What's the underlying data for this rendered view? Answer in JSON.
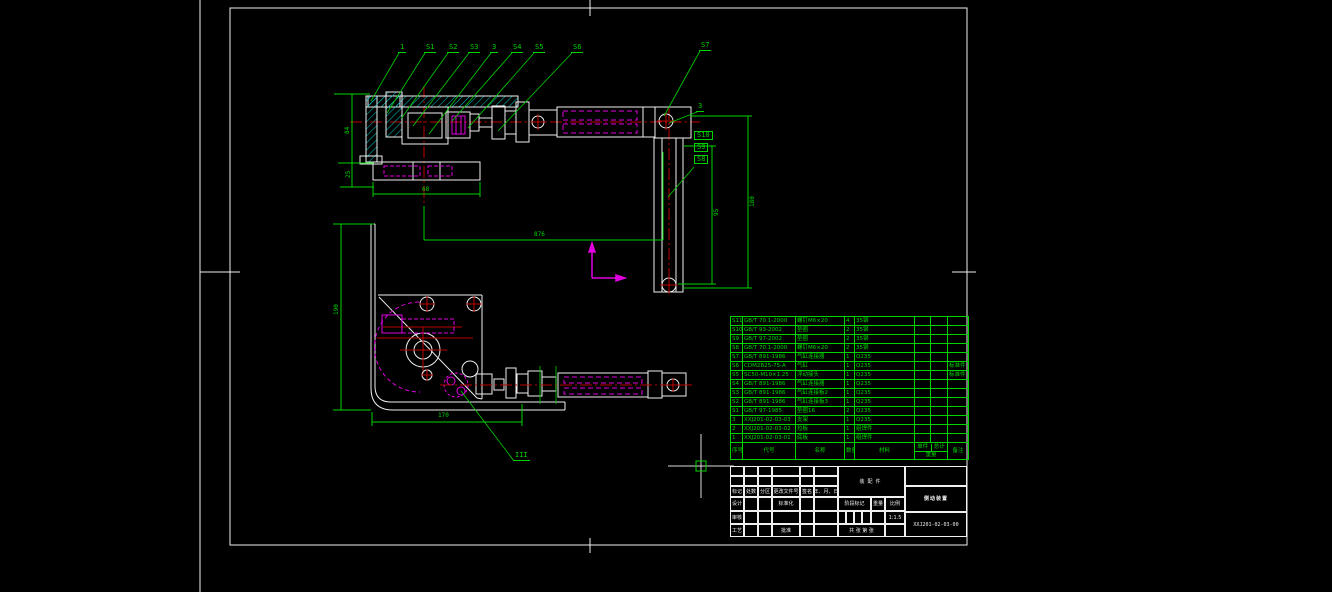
{
  "colors": {
    "background": "#000000",
    "lines_white": "#efefef",
    "lines_green": "#00d400",
    "lines_magenta": "#e000e0",
    "lines_red": "#bb0000",
    "hatch_cyan": "#00c8c8"
  },
  "callouts": [
    {
      "label": "1",
      "x": 398,
      "y": 44,
      "lx": 371,
      "ly": 101
    },
    {
      "label": "S1",
      "x": 424,
      "y": 44,
      "lx": 387,
      "ly": 113
    },
    {
      "label": "S2",
      "x": 447,
      "y": 44,
      "lx": 401,
      "ly": 119
    },
    {
      "label": "S3",
      "x": 468,
      "y": 44,
      "lx": 413,
      "ly": 126
    },
    {
      "label": "3",
      "x": 490,
      "y": 44,
      "lx": 429,
      "ly": 134
    },
    {
      "label": "S4",
      "x": 511,
      "y": 44,
      "lx": 452,
      "ly": 121
    },
    {
      "label": "S5",
      "x": 533,
      "y": 44,
      "lx": 468,
      "ly": 128
    },
    {
      "label": "S6",
      "x": 571,
      "y": 44,
      "lx": 498,
      "ly": 131
    },
    {
      "label": "S7",
      "x": 699,
      "y": 42,
      "lx": 664,
      "ly": 116
    },
    {
      "label": "3",
      "x": 696,
      "y": 103,
      "lx": 669,
      "ly": 123
    },
    {
      "label": "S10",
      "x": 694,
      "y": 131,
      "boxed": true
    },
    {
      "label": "S9",
      "x": 694,
      "y": 143,
      "boxed": true
    },
    {
      "label": "S8",
      "x": 694,
      "y": 155,
      "boxed": true
    },
    {
      "label": "III",
      "x": 513,
      "y": 452,
      "lx": 461,
      "ly": 391
    }
  ],
  "dimensions": [
    {
      "text": "84",
      "x": 345,
      "y": 134,
      "rot": true
    },
    {
      "text": "25",
      "x": 346,
      "y": 178,
      "rot": true
    },
    {
      "text": "68",
      "x": 422,
      "y": 187
    },
    {
      "text": "876",
      "x": 534,
      "y": 232
    },
    {
      "text": "95",
      "x": 714,
      "y": 216,
      "rot": true
    },
    {
      "text": "180",
      "x": 750,
      "y": 207,
      "rot": true
    },
    {
      "text": "190",
      "x": 334,
      "y": 315,
      "rot": true
    },
    {
      "text": "170",
      "x": 438,
      "y": 413
    }
  ],
  "bom": {
    "col_headers": {
      "no": "序号",
      "code": "代号",
      "name": "名称",
      "qty": "数量",
      "material": "材料",
      "unit": "单件",
      "total": "总计",
      "weight": "重量",
      "note": "备注"
    },
    "rows": [
      {
        "no": "S11",
        "code": "GB/T 70.1-2000",
        "name": "螺钉M6×20",
        "qty": "4",
        "material": "35钢",
        "note": ""
      },
      {
        "no": "S10",
        "code": "GB/T 93-2002",
        "name": "垫圈",
        "qty": "2",
        "material": "35钢",
        "note": ""
      },
      {
        "no": "S9",
        "code": "GB/T 97-2002",
        "name": "垫圈",
        "qty": "2",
        "material": "35钢",
        "note": ""
      },
      {
        "no": "S8",
        "code": "GB/T 70.1-2000",
        "name": "螺钉M6×20",
        "qty": "2",
        "material": "35钢",
        "note": ""
      },
      {
        "no": "S7",
        "code": "GB/T 891-1986",
        "name": "气缸连接器",
        "qty": "1",
        "material": "Q235",
        "note": ""
      },
      {
        "no": "S6",
        "code": "CDM2B25-75-A",
        "name": "气缸",
        "qty": "1",
        "material": "Q235",
        "note": "标准件"
      },
      {
        "no": "S5",
        "code": "SC50-M10×1.25",
        "name": "浮动接头",
        "qty": "1",
        "material": "Q235",
        "note": "标准件"
      },
      {
        "no": "S4",
        "code": "GB/T 891-1986",
        "name": "气缸连接器",
        "qty": "1",
        "material": "Q235",
        "note": ""
      },
      {
        "no": "S3",
        "code": "GB/T 891-1986",
        "name": "气缸连接板2",
        "qty": "1",
        "material": "Q235",
        "note": ""
      },
      {
        "no": "S2",
        "code": "GB/T 891-1986",
        "name": "气缸连接板3",
        "qty": "1",
        "material": "Q235",
        "note": ""
      },
      {
        "no": "S1",
        "code": "GB/T 97-1985",
        "name": "垫圈16",
        "qty": "2",
        "material": "Q235",
        "note": ""
      },
      {
        "no": "3",
        "code": "XXJ201-02-03-03",
        "name": "支架",
        "qty": "1",
        "material": "Q235",
        "note": ""
      },
      {
        "no": "2",
        "code": "XXJ201-02-03-02",
        "name": "拉板",
        "qty": "1",
        "material": "组焊件",
        "note": ""
      },
      {
        "no": "1",
        "code": "XXJ201-02-03-01",
        "name": "底板",
        "qty": "1",
        "material": "组焊件",
        "note": ""
      }
    ]
  },
  "title_block": {
    "left_cells": [
      "",
      "",
      "",
      "",
      "",
      "",
      "",
      "",
      "",
      "",
      "",
      "",
      "标记",
      "处数",
      "分区",
      "更改文件号",
      "签名",
      "年、月、日",
      "设计",
      "",
      "",
      "标准化",
      "",
      "",
      "审核",
      "",
      "",
      "",
      "",
      "",
      "工艺",
      "",
      "",
      "批准",
      "",
      ""
    ],
    "doc_type": "装配件",
    "stage_label": "阶段标记",
    "weight_label": "重量",
    "scale_label": "比例",
    "scale_value": "1:1.5",
    "sheet_note": "共 张 第 张",
    "title": "侧动装置",
    "drawing_no": "XXJ201-02-03-00"
  },
  "cursor": {
    "x": 701,
    "y": 466
  }
}
